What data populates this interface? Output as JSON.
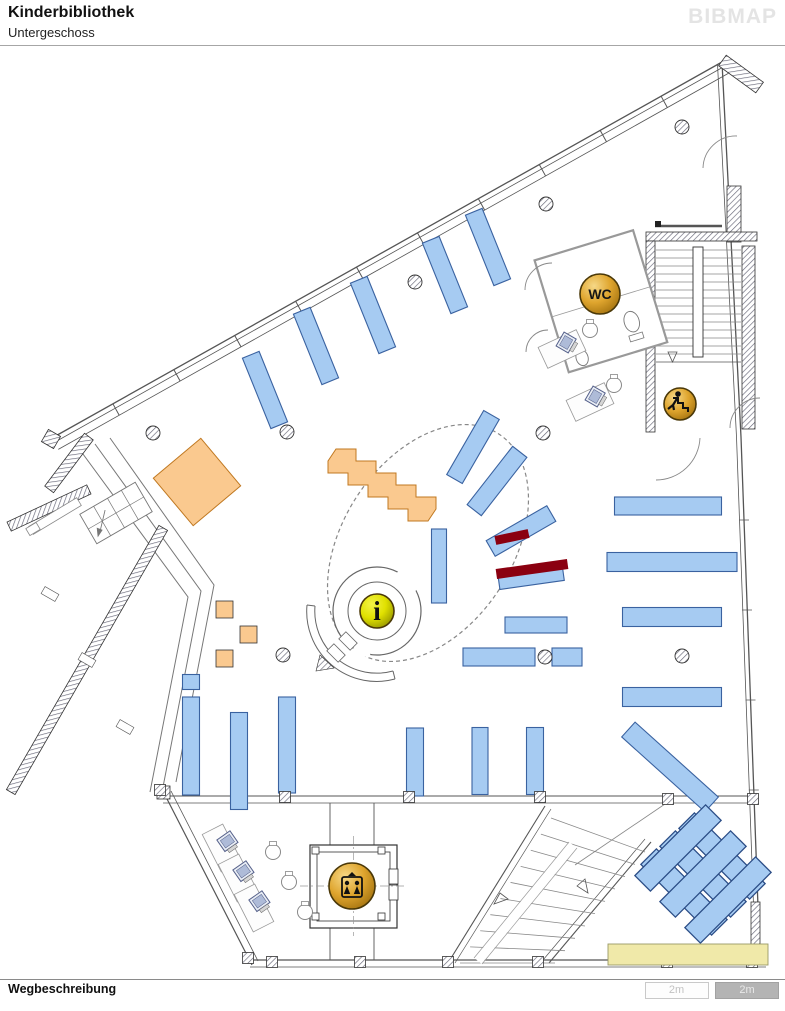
{
  "header": {
    "title": "Kinderbibliothek",
    "subtitle": "Untergeschoss",
    "logo": "BIBMAP"
  },
  "footer": {
    "label": "Wegbeschreibung",
    "scale_segments": [
      "2m",
      "2m"
    ]
  },
  "map": {
    "colors": {
      "shelf": "#A6CBF2",
      "shelf_border": "#3A62A0",
      "weave_border": "#2B4D86",
      "orange": "#FAC98F",
      "orange_border": "#C07820",
      "red": "#8B0010",
      "yellow_bar": "#F0E9A9",
      "yellow_bar_border": "#9A9A66",
      "wall": "#555555",
      "icon_border": "#4A3808"
    },
    "icons": [
      {
        "type": "wc-icon",
        "label": "WC",
        "cx": 600,
        "cy": 294,
        "r": 20
      },
      {
        "type": "info-icon",
        "label": "i",
        "cx": 377,
        "cy": 611,
        "r": 17
      },
      {
        "type": "stairs-down-icon",
        "label": "",
        "cx": 680,
        "cy": 404,
        "r": 16
      },
      {
        "type": "elevator-icon",
        "label": "",
        "cx": 352,
        "cy": 886,
        "r": 23
      }
    ],
    "shelves": [
      [
        265,
        390,
        18,
        76,
        -22
      ],
      [
        316,
        346,
        18,
        76,
        -22
      ],
      [
        373,
        315,
        18,
        76,
        -22
      ],
      [
        445,
        275,
        18,
        76,
        -22
      ],
      [
        488,
        247,
        18,
        76,
        -22
      ],
      [
        473,
        447,
        18,
        74,
        30
      ],
      [
        497,
        481,
        18,
        74,
        38
      ],
      [
        521,
        531,
        18,
        70,
        60
      ],
      [
        531,
        577,
        65,
        16,
        -8
      ],
      [
        439,
        566,
        15,
        74,
        0
      ],
      [
        536,
        625,
        62,
        16,
        0
      ],
      [
        499,
        657,
        72,
        18,
        0
      ],
      [
        567,
        657,
        30,
        18,
        0
      ],
      [
        668,
        506,
        107,
        18,
        0
      ],
      [
        672,
        562,
        130,
        19,
        0
      ],
      [
        672,
        617,
        99,
        19,
        0
      ],
      [
        672,
        697,
        99,
        19,
        0
      ],
      [
        670,
        767,
        20,
        112,
        -48
      ],
      [
        191,
        682,
        17,
        15,
        0
      ],
      [
        191,
        746,
        17,
        98,
        0
      ],
      [
        239,
        761,
        17,
        97,
        0
      ],
      [
        287,
        745,
        17,
        96,
        0
      ],
      [
        415,
        762,
        17,
        68,
        0
      ],
      [
        480,
        761,
        16,
        67,
        0
      ],
      [
        535,
        761,
        17,
        67,
        0
      ]
    ],
    "weave_shelves": [
      [
        684,
        892,
        -45
      ],
      [
        703,
        874,
        -45
      ],
      [
        722,
        856,
        -45
      ],
      [
        678,
        848,
        45
      ],
      [
        703,
        874,
        45
      ],
      [
        728,
        900,
        45
      ]
    ],
    "red_markers": [
      [
        512,
        537,
        34,
        9,
        -12
      ],
      [
        532,
        569,
        72,
        10,
        -8
      ]
    ],
    "orange_shapes": {
      "big_square": {
        "cx": 197,
        "cy": 482,
        "size": 62,
        "rot": -40
      },
      "steps_points": "336,449 356,449 356,461 376,461 376,473 396,473 396,485 416,485 416,497 436,497 436,509 428,521 408,521 408,509 388,509 388,497 368,497 368,485 348,485 348,473 328,473 328,461",
      "small_squares": [
        [
          216,
          601
        ],
        [
          240,
          626
        ],
        [
          216,
          650
        ]
      ]
    },
    "columns": [
      [
        153,
        433
      ],
      [
        287,
        432
      ],
      [
        283,
        655
      ],
      [
        415,
        282
      ],
      [
        546,
        204
      ],
      [
        543,
        433
      ],
      [
        545,
        657
      ],
      [
        682,
        127
      ],
      [
        682,
        656
      ]
    ],
    "piers": [
      [
        285,
        797
      ],
      [
        409,
        797
      ],
      [
        540,
        797
      ],
      [
        668,
        799
      ],
      [
        753,
        799
      ],
      [
        272,
        962
      ],
      [
        360,
        962
      ],
      [
        448,
        962
      ],
      [
        538,
        962
      ],
      [
        667,
        962
      ],
      [
        752,
        962
      ],
      [
        160,
        790
      ],
      [
        248,
        958
      ]
    ],
    "yellow_bar": {
      "x": 608,
      "y": 944,
      "w": 160,
      "h": 21
    },
    "computers": [
      [
        228,
        842,
        -35
      ],
      [
        244,
        872,
        -35
      ],
      [
        260,
        902,
        -35
      ],
      [
        567,
        343,
        -60
      ],
      [
        596,
        397,
        -60
      ]
    ],
    "desks": [
      [
        222,
        848,
        63
      ],
      [
        238,
        878,
        63
      ],
      [
        254,
        908,
        63
      ],
      [
        562,
        349,
        -25
      ],
      [
        590,
        402,
        -25
      ]
    ],
    "chairs": [
      [
        273,
        852
      ],
      [
        289,
        882
      ],
      [
        305,
        912
      ],
      [
        590,
        330
      ],
      [
        614,
        385
      ]
    ]
  }
}
